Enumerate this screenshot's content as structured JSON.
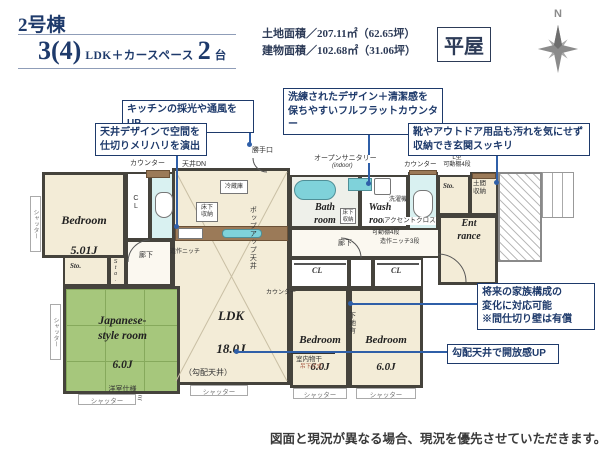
{
  "header": {
    "unit_title": "2号棟",
    "plan_big1": "3(4)",
    "plan_small1": "LDK＋カースペース",
    "plan_big2": "2",
    "plan_small2": "台",
    "areas": "土地面積／207.11㎡（62.65坪）\n建物面積／102.68㎡（31.06坪）",
    "type_badge": "平屋",
    "compass_label": "N"
  },
  "callouts": {
    "kitchen": "キッチンの採光や通風をUP",
    "ceiling": "天井デザインで空間を\n仕切りメリハリを演出",
    "counter": "洗練されたデザイン＋清潔感を\n保ちやすいフルフラットカウンター",
    "genkan": "靴やアウトドア用品も汚れを気にせず\n収納でき玄関スッキリ",
    "future": "将来の家族構成の\n変化に対応可能\n※間仕切り壁は有償",
    "vaulted": "勾配天井で開放感UP"
  },
  "rooms": {
    "bedroom1_name": "Bedroom",
    "bedroom1_size": "5.01J",
    "japanese_name": "Japanese-\nstyle room",
    "japanese_size": "6.0J",
    "japanese_note": "洋室仕様\n縁なしタタミ",
    "ldk_name": "LDK",
    "ldk_size": "18.0J",
    "ldk_note": "（勾配天井）",
    "bedroom2_name": "Bedroom",
    "bedroom2_size": "6.0J",
    "bedroom3_name": "Bedroom",
    "bedroom3_size": "6.0J",
    "bath_name": "Bath\nroom",
    "wash_name": "Wash\nroom",
    "entrance_name": "Ent\nrance"
  },
  "plan_labels": {
    "counter": "カウンター",
    "ceiling_dn": "天井DN",
    "kitchen_door": "勝手口",
    "fridge": "冷蔵庫",
    "floor_storage": "床下\n収納",
    "niche": "造作ニッチ",
    "popup_ceiling": "ポップアップ天井",
    "hall": "廊下",
    "open_sanitary": "オープンサニタリー",
    "open_sanitary_sub": "(indoor)",
    "accent_cloth": "アクセントクロス",
    "washer": "洗濯機",
    "l_shelf": "L型\n可動棚4段",
    "shelf4": "可動棚4段",
    "niche3": "造作ニッチ3段",
    "doma": "土間\n収納",
    "sto": "Sto.",
    "cl": "CL",
    "shutter": "シャッター",
    "base_wall": "下地有",
    "indoor_dry": "室内物干",
    "indoor_dry_sub": "吊下げ式",
    "vaulted_note": "（勾配天井）"
  },
  "footer": {
    "note": "図面と現況が異なる場合、現況を優先させていただきます。"
  },
  "colors": {
    "navy": "#1e3a6b",
    "blue": "#2f5fa8",
    "cream": "#f3ecd7",
    "green": "#a6c77c",
    "teal": "#7fd2da",
    "tealLight": "#d9f1f1",
    "wall": "#45433c",
    "brown": "#9b7a58",
    "gray": "#8b8b8b"
  }
}
